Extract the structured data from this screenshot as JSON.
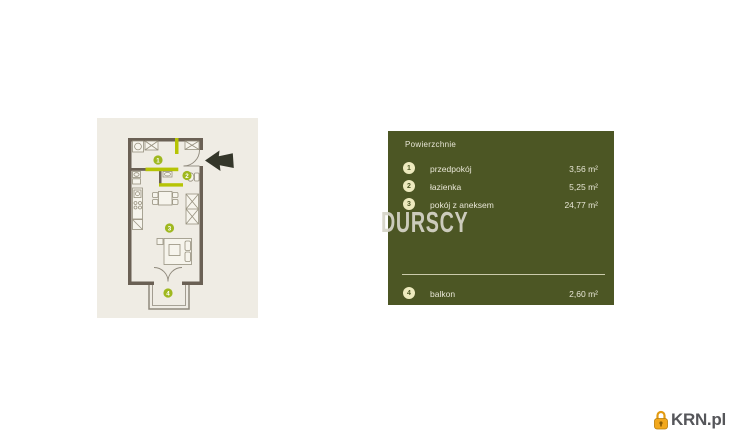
{
  "watermark": {
    "text": "DURSCY"
  },
  "logo": {
    "text": "KRN.pl",
    "icon": "padlock-icon",
    "icon_color": "#f2a81d",
    "text_color": "#55565a"
  },
  "floor_plan": {
    "background_color": "#efece4",
    "wall_color": "#6a6054",
    "accent_color": "#b6c405",
    "marker_color": "#9fb81f",
    "markers": [
      {
        "number": "1"
      },
      {
        "number": "2"
      },
      {
        "number": "3"
      },
      {
        "number": "4"
      }
    ],
    "entrance_arrow": "left-arrow-icon"
  },
  "panel": {
    "background_color": "#4c5624",
    "text_color": "#e8e6d6",
    "badge_color": "#edeabe",
    "title": "Powierzchnie",
    "rows": [
      {
        "number": "1",
        "label": "przedpokój",
        "area": "3,56 m²"
      },
      {
        "number": "2",
        "label": "łazienka",
        "area": "5,25 m²"
      },
      {
        "number": "3",
        "label": "pokój z aneksem",
        "area": "24,77 m²"
      }
    ],
    "balcony_row": {
      "number": "4",
      "label": "balkon",
      "area": "2,60 m²"
    }
  }
}
